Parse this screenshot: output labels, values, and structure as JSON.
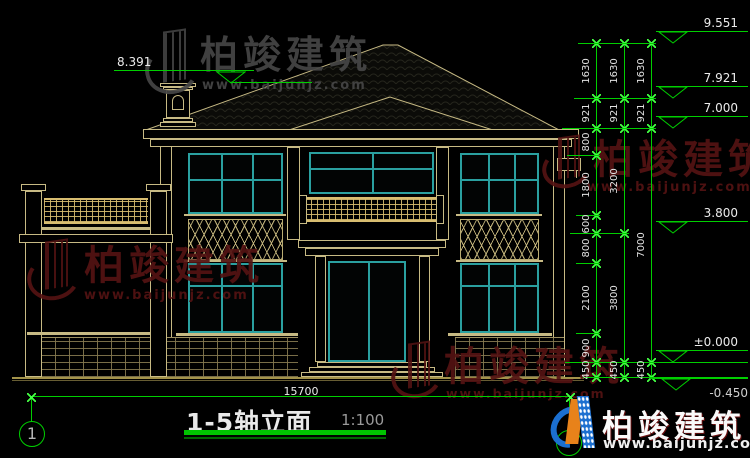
{
  "watermark": {
    "brand": "柏竣建筑",
    "url": "www.baijunjz.com",
    "logo_icon": "building-logo-icon"
  },
  "footer_logo": {
    "brand": "柏竣建筑",
    "url": "www.baijunjz.com",
    "icon": "baijun-building-logo-icon"
  },
  "title_block": {
    "title": "1-5轴立面",
    "scale": "1:100"
  },
  "axis_bubbles": {
    "left": "1"
  },
  "dimensions": {
    "overall_width": "15700",
    "col_inner": [
      "1630",
      "921",
      "800",
      "1800",
      "600",
      "800",
      "2100",
      "900",
      "450"
    ],
    "col_mid": [
      "1630",
      "921",
      "3200",
      "3800",
      "450"
    ],
    "col_outer": [
      "1630",
      "921",
      "7000",
      "450"
    ]
  },
  "elevations": {
    "ridge": "9.551",
    "chimney": "8.391",
    "upper_eave": "7.921",
    "eave": "7.000",
    "second_floor": "3.800",
    "zero": "±0.000",
    "ground": "-0.450"
  },
  "colors": {
    "dim_green": "#00cf00",
    "line_tan": "#c7ba84",
    "window_teal": "#2aa0a0",
    "watermark_red": "#541313",
    "watermark_gray": "#464646",
    "ground_yellow": "#a3934a"
  }
}
